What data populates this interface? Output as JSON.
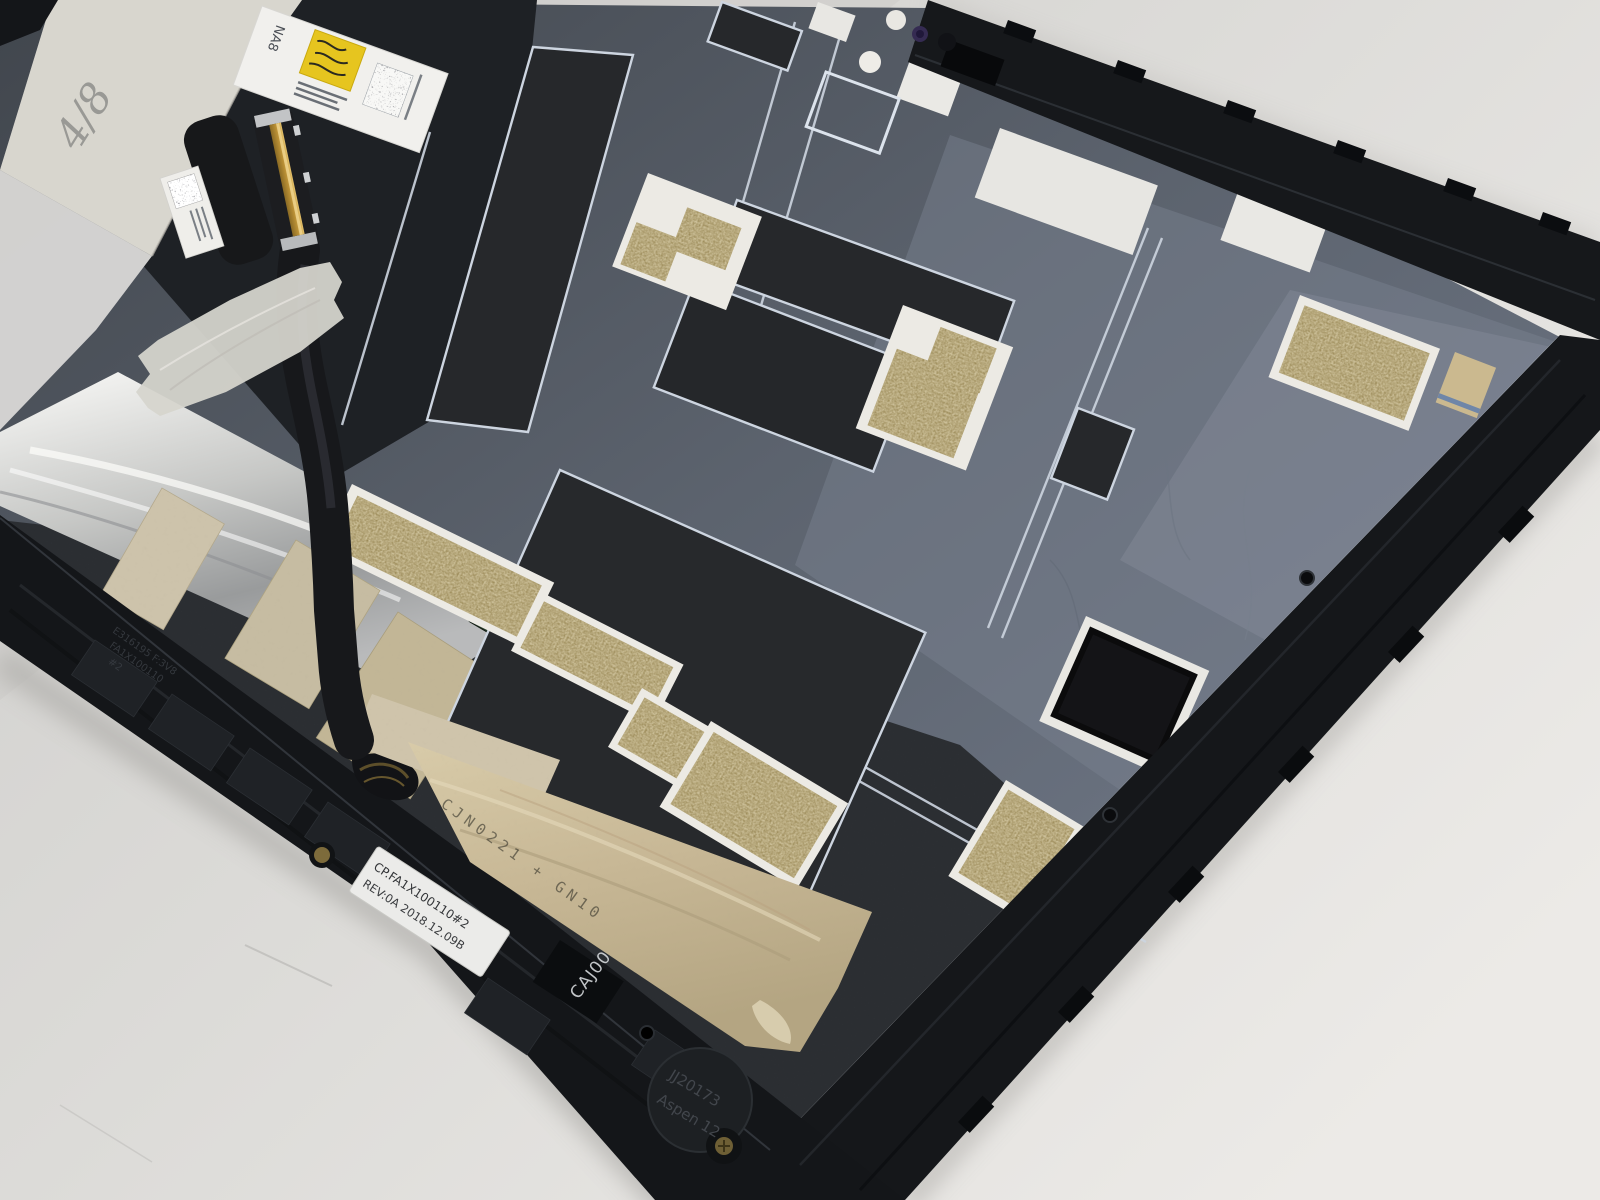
{
  "photo": {
    "subject": "tablet-display-back-cover-internal-assembly-on-table",
    "texts": {
      "handwritten_note": "4/8",
      "top_label_code": "NA8",
      "frame_label_line1": "CP.FA1X100110#2",
      "frame_label_line2": "REV:0A 2018.12.09B",
      "tape_print": "CJN0221 + GN10",
      "molded_cavity_code": "CAJ00",
      "molded_mold_id": "JJ20173",
      "molded_project": "Aspen 12",
      "molded_cert_line1": "E316195 F:3V8",
      "molded_cert_line2": "FA1X100110",
      "molded_cert_line3": "#2"
    },
    "colors": {
      "table": "#dcdbd8",
      "panel_mylar": "#5a616b",
      "graphite_pad": "#26282b",
      "frame_plastic": "#16181b",
      "emi_gold_mesh": "#a08c58",
      "foil_silver": "#d9dad8",
      "tape_tan": "#c7b795",
      "tape_crepe": "#d6d4cd",
      "trace_outline": "#cdd5e0",
      "label_white": "#ededeb",
      "sticker_yellow": "#e6c51f"
    }
  }
}
